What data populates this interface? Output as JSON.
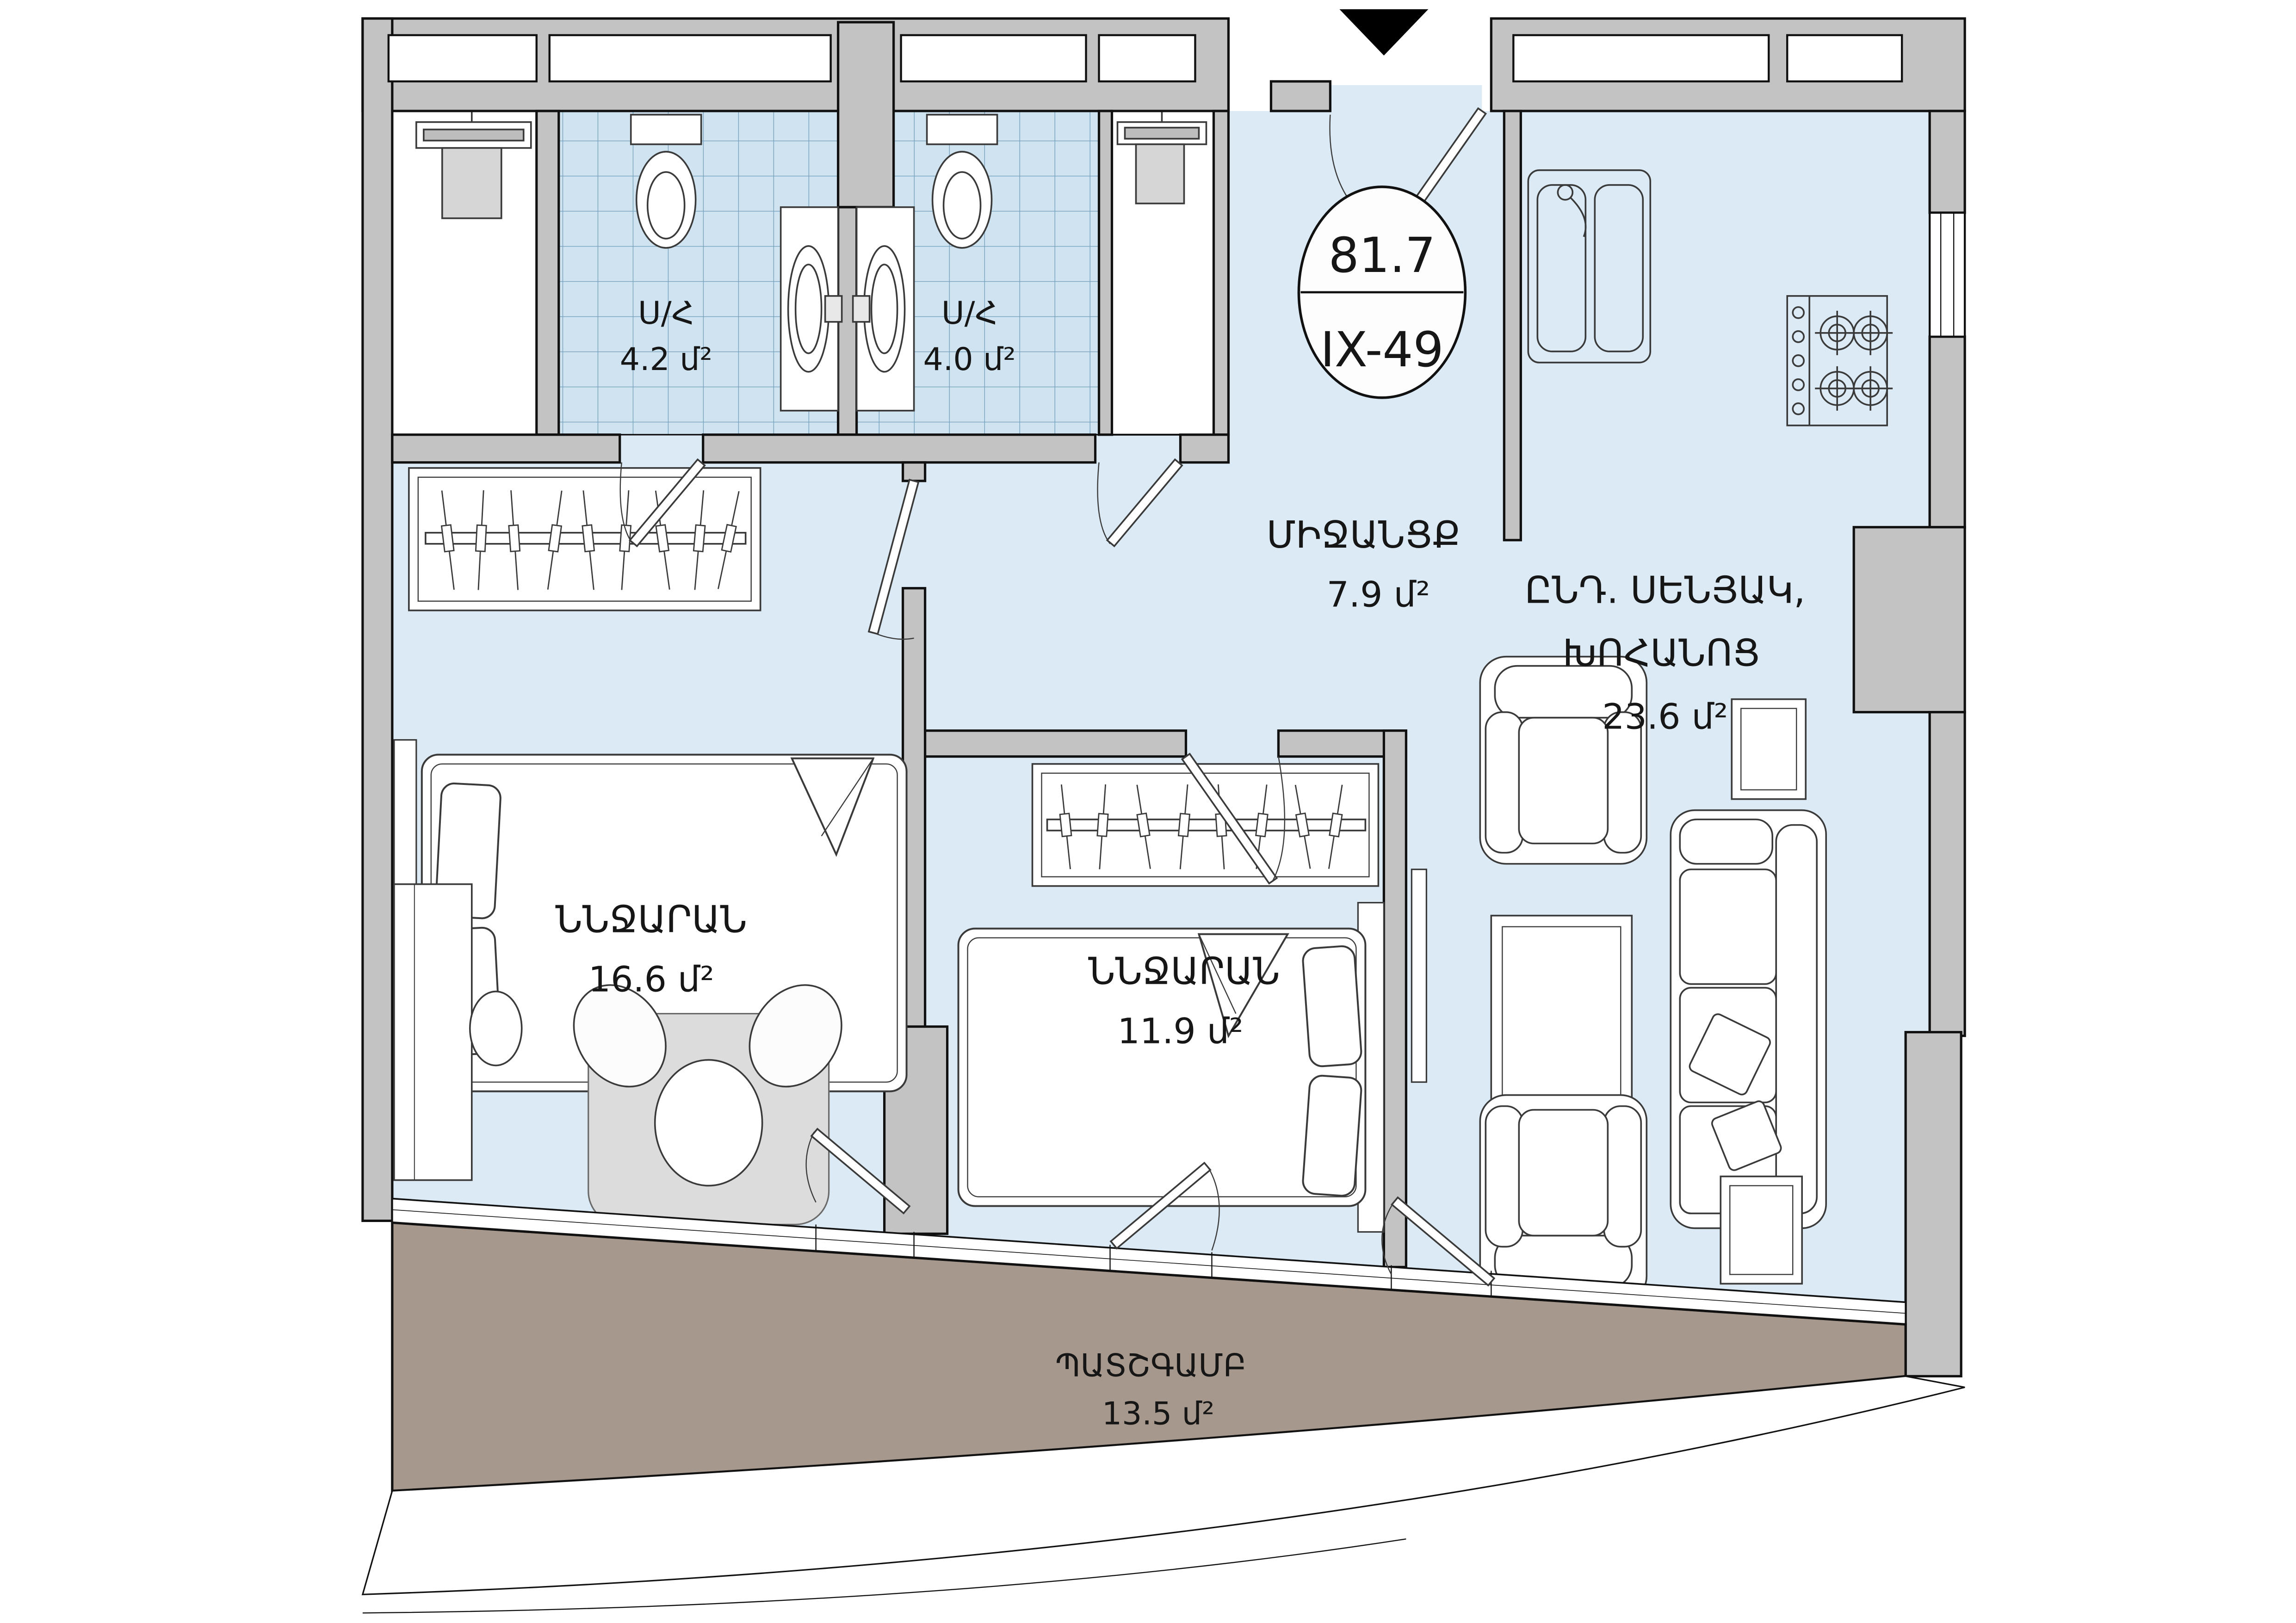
{
  "badge": {
    "area": "81.7",
    "unit": "IX-49"
  },
  "rooms": {
    "bath1": {
      "name": "Ս/Հ",
      "area": "4.2 մ²"
    },
    "bath2": {
      "name": "Ս/Հ",
      "area": "4.0 մ²"
    },
    "hallway": {
      "name": "ՄԻՋԱՆՑՔ",
      "area": "7.9 մ²"
    },
    "living": {
      "name1": "ԸՆԴ. ՍԵՆՅԱԿ,",
      "name2": "ԽՈՀԱՆՈՑ",
      "area": "23.6 մ²"
    },
    "bedroom1": {
      "name": "ՆՆՋԱՐԱՆ",
      "area": "16.6 մ²"
    },
    "bedroom2": {
      "name": "ՆՆՋԱՐԱՆ",
      "area": "11.9 մ²"
    },
    "balcony": {
      "name": "ՊԱՏՇԳԱՄԲ",
      "area": "13.5 մ²"
    }
  },
  "colors": {
    "floor": "#dbeaf4",
    "tile": "#cfe4f0",
    "tile_line": "#76a0bc",
    "wall": "#c3c3c3",
    "balcony": "#a6988c",
    "outline": "#111111",
    "furniture_stroke": "#3a3a3a"
  }
}
